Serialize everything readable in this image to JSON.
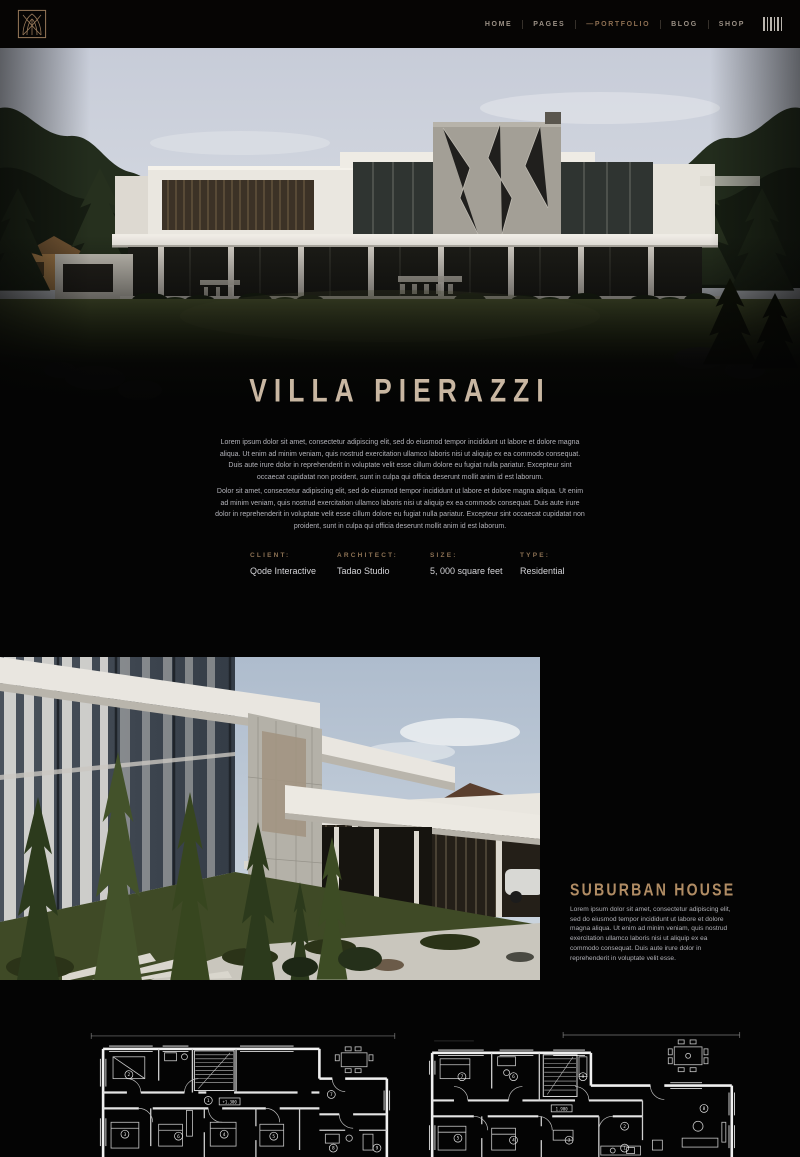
{
  "colors": {
    "background": "#040404",
    "accent_tan": "#a08463",
    "title_beige": "#c9b7a2",
    "nav_active": "#8d6f52",
    "nav_muted": "#9b9186",
    "detail_label": "#8d7254",
    "body_text": "#b3b3ba"
  },
  "header": {
    "logo_icon": "gothic-arch-monogram",
    "nav": [
      {
        "label": "HOME",
        "active": false
      },
      {
        "label": "PAGES",
        "active": false
      },
      {
        "label": "—PORTFOLIO",
        "active": true
      },
      {
        "label": "BLOG",
        "active": false
      },
      {
        "label": "SHOP",
        "active": false
      }
    ],
    "menu_icon": "vertical-bars-menu"
  },
  "hero": {
    "title": "VILLA PIERAZZI",
    "paragraph1": "Lorem ipsum dolor sit amet, consectetur adipiscing elit, sed do eiusmod tempor incididunt ut labore et dolore magna aliqua. Ut enim ad minim veniam, quis nostrud exercitation ullamco laboris nisi ut aliquip ex ea commodo consequat. Duis aute irure dolor in reprehenderit in voluptate velit esse cillum dolore eu fugiat nulla pariatur. Excepteur sint occaecat cupidatat non proident, sunt in culpa qui officia deserunt mollit anim id est laborum.",
    "paragraph2": "Dolor sit amet, consectetur adipiscing elit, sed do eiusmod tempor incididunt ut labore et dolore magna aliqua. Ut enim ad minim veniam, quis nostrud exercitation ullamco laboris nisi ut aliquip ex ea commodo consequat. Duis aute irure dolor in reprehenderit in voluptate velit esse cillum dolore eu fugiat nulla pariatur. Excepteur sint occaecat cupidatat non proident, sunt in culpa qui officia deserunt mollit anim id est laborum."
  },
  "details": {
    "items": [
      {
        "label": "CLIENT:",
        "value": "Qode Interactive"
      },
      {
        "label": "ARCHITECT:",
        "value": "Tadao Studio"
      },
      {
        "label": "SIZE:",
        "value": "5, 000 square feet"
      },
      {
        "label": "TYPE:",
        "value": "Residential"
      }
    ]
  },
  "suburban": {
    "title": "SUBURBAN HOUSE",
    "paragraph": "Lorem ipsum dolor sit amet, consectetur adipiscing elit, sed do eiusmod tempor incididunt ut labore et dolore magna aliqua. Ut enim ad minim veniam, quis nostrud exercitation ullamco laboris nisi ut aliquip ex ea commodo consequat. Duis aute irure dolor in reprehenderit in voluptate velit esse."
  },
  "floorplans": {
    "left": {
      "level_label": "+1.300",
      "rooms": [
        "1",
        "2",
        "3",
        "4",
        "5",
        "6",
        "7",
        "8",
        "9"
      ]
    },
    "right": {
      "level_label": "1.900",
      "rooms": [
        "1",
        "2",
        "3",
        "4",
        "5",
        "6",
        "7",
        "8",
        "9"
      ]
    }
  }
}
